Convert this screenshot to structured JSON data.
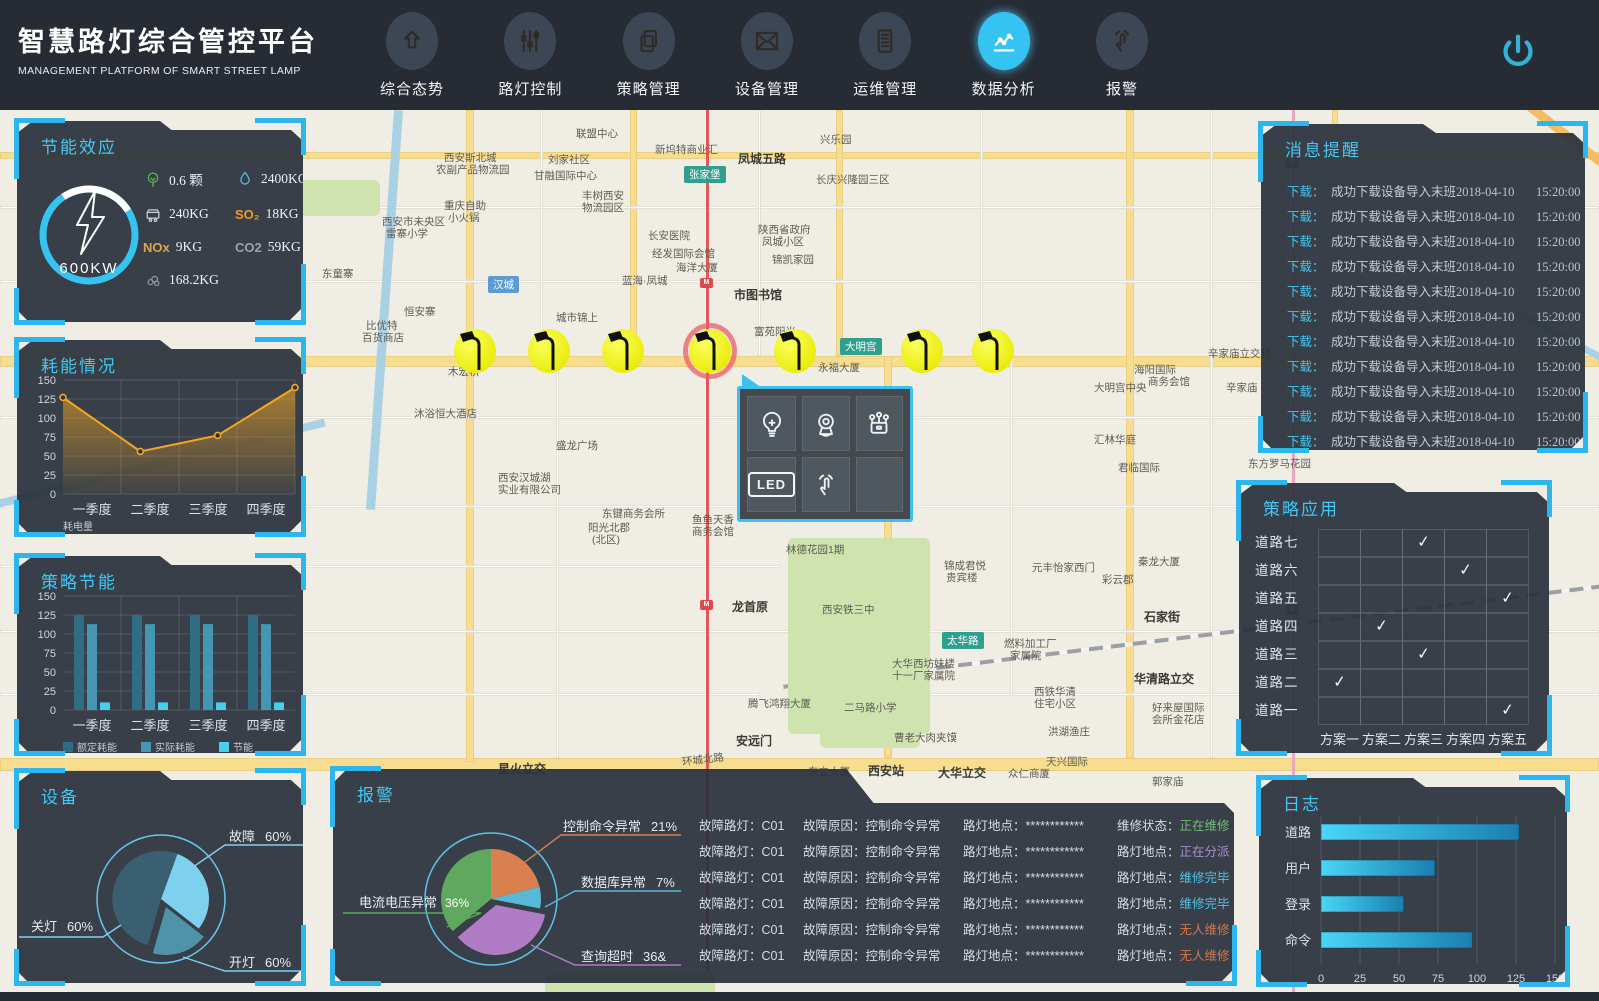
{
  "header": {
    "title": "智慧路灯综合管控平台",
    "subtitle": "MANAGEMENT PLATFORM OF SMART STREET LAMP",
    "nav": [
      {
        "label": "综合态势",
        "icon": "arrow-up-icon",
        "active": false
      },
      {
        "label": "路灯控制",
        "icon": "sliders-icon",
        "active": false
      },
      {
        "label": "策略管理",
        "icon": "copy-icon",
        "active": false
      },
      {
        "label": "设备管理",
        "icon": "mail-icon",
        "active": false
      },
      {
        "label": "运维管理",
        "icon": "document-icon",
        "active": false
      },
      {
        "label": "数据分析",
        "icon": "chart-line-icon",
        "active": true
      },
      {
        "label": "报警",
        "icon": "touch-icon",
        "active": false
      }
    ],
    "power_icon": "power-icon"
  },
  "colors": {
    "accent_cyan": "#2db6ee",
    "title_cyan": "#41c8f5",
    "panel_bg": "#2a313c",
    "header_bg": "#262b34"
  },
  "panels": {
    "energy_effect": {
      "title": "节能效应",
      "gauge": {
        "value": "600KW",
        "icon": "lightning-icon"
      },
      "stats": [
        {
          "icon": "tree-icon",
          "color": "#55b54e",
          "value": "0.6 颗"
        },
        {
          "icon": "water-drop-icon",
          "color": "#58bbe8",
          "value": "2400KG"
        },
        {
          "icon": "coal-cart-icon",
          "color": "#c7d0d6",
          "value": "240KG"
        },
        {
          "text": "SO₂",
          "color": "#f09a2e",
          "value": "18KG"
        },
        {
          "text": "NOx",
          "color": "#d8a84e",
          "value": "9KG"
        },
        {
          "text": "CO2",
          "color": "#9aa4ad",
          "value": "59KG"
        },
        {
          "icon": "smoke-icon",
          "color": "#8d97a1",
          "value": "168.2KG"
        }
      ]
    },
    "consumption": {
      "title": "耗能情况",
      "chart": {
        "type": "line",
        "categories": [
          "一季度",
          "二季度",
          "三季度",
          "四季度"
        ],
        "values": [
          127,
          56,
          77,
          140
        ],
        "yticks": [
          0,
          25,
          50,
          75,
          100,
          125,
          150
        ],
        "ylim": [
          0,
          150
        ],
        "legend": "耗电量",
        "line_color": "#f5a623"
      }
    },
    "strategy_saving": {
      "title": "策略节能",
      "chart": {
        "type": "bar",
        "categories": [
          "一季度",
          "二季度",
          "三季度",
          "四季度"
        ],
        "yticks": [
          0,
          25,
          50,
          75,
          100,
          125,
          150
        ],
        "ylim": [
          0,
          150
        ],
        "series": [
          {
            "name": "额定耗能",
            "color": "#2e6d84",
            "values": [
              125,
              125,
              125,
              125
            ]
          },
          {
            "name": "实际耗能",
            "color": "#4496b2",
            "values": [
              113,
              113,
              113,
              113
            ]
          },
          {
            "name": "节能",
            "color": "#49cdec",
            "values": [
              10,
              10,
              10,
              10
            ]
          }
        ]
      }
    },
    "device": {
      "title": "设备",
      "chart": {
        "type": "pie",
        "slices": [
          {
            "label": "故障",
            "value_text": "60%",
            "color": "#7ed0ef"
          },
          {
            "label": "开灯",
            "value_text": "60%",
            "color": "#4f93a8"
          },
          {
            "label": "关灯",
            "value_text": "60%",
            "color": "#3a5f70"
          }
        ]
      }
    },
    "messages": {
      "title": "消息提醒",
      "items": [
        {
          "prefix": "下载：",
          "text": "成功下载设备导入末班",
          "date": "2018-04-10",
          "time": "15:20:00"
        },
        {
          "prefix": "下载：",
          "text": "成功下载设备导入末班",
          "date": "2018-04-10",
          "time": "15:20:00"
        },
        {
          "prefix": "下载：",
          "text": "成功下载设备导入末班",
          "date": "2018-04-10",
          "time": "15:20:00"
        },
        {
          "prefix": "下载：",
          "text": "成功下载设备导入末班",
          "date": "2018-04-10",
          "time": "15:20:00"
        },
        {
          "prefix": "下载：",
          "text": "成功下载设备导入末班",
          "date": "2018-04-10",
          "time": "15:20:00"
        },
        {
          "prefix": "下载：",
          "text": "成功下载设备导入末班",
          "date": "2018-04-10",
          "time": "15:20:00"
        },
        {
          "prefix": "下载：",
          "text": "成功下载设备导入末班",
          "date": "2018-04-10",
          "time": "15:20:00"
        },
        {
          "prefix": "下载：",
          "text": "成功下载设备导入末班",
          "date": "2018-04-10",
          "time": "15:20:00"
        },
        {
          "prefix": "下载：",
          "text": "成功下载设备导入末班",
          "date": "2018-04-10",
          "time": "15:20:00"
        },
        {
          "prefix": "下载：",
          "text": "成功下载设备导入末班",
          "date": "2018-04-10",
          "time": "15:20:00"
        },
        {
          "prefix": "下载：",
          "text": "成功下载设备导入末班",
          "date": "2018-04-10",
          "time": "15:20:00"
        }
      ]
    },
    "strategy_apply": {
      "title": "策略应用",
      "roads": [
        "道路七",
        "道路六",
        "道路五",
        "道路四",
        "道路三",
        "道路二",
        "道路一"
      ],
      "plans": [
        "方案一",
        "方案二",
        "方案三",
        "方案四",
        "方案五"
      ],
      "checks": [
        3,
        4,
        5,
        2,
        3,
        1,
        5
      ],
      "check_glyph": "✓"
    },
    "log": {
      "title": "日志",
      "chart": {
        "type": "bar-horizontal",
        "categories": [
          "道路",
          "用户",
          "登录",
          "命令"
        ],
        "values": [
          127,
          73,
          53,
          97
        ],
        "xticks": [
          0,
          25,
          50,
          75,
          100,
          125,
          150
        ],
        "xlim": [
          0,
          150
        ],
        "bar_color_start": "#48d6f8",
        "bar_color_end": "#1a7fb0"
      }
    },
    "alarm": {
      "title": "报警",
      "pie": {
        "slices": [
          {
            "label": "电流电压异常",
            "pct": "36%",
            "color": "#5fa85d"
          },
          {
            "label": "控制命令异常",
            "pct": "21%",
            "color": "#d9804f"
          },
          {
            "label": "数据库异常",
            "pct": "7%",
            "color": "#58b8d8"
          },
          {
            "label": "查询超时",
            "pct": "36&",
            "color": "#b07cc6"
          }
        ],
        "inner_value": "36%"
      },
      "rows": [
        {
          "c1l": "故障路灯：",
          "c1": "C01",
          "c2l": "故障原因：",
          "c2": "控制命令异常",
          "c3l": "路灯地点：",
          "c3": "************",
          "c4l": "维修状态：",
          "c4": "正在维修",
          "c4c": "#6fbf73"
        },
        {
          "c1l": "故障路灯：",
          "c1": "C01",
          "c2l": "故障原因：",
          "c2": "控制命令异常",
          "c3l": "路灯地点：",
          "c3": "************",
          "c4l": "路灯地点：",
          "c4": "正在分派",
          "c4c": "#a98fd1"
        },
        {
          "c1l": "故障路灯：",
          "c1": "C01",
          "c2l": "故障原因：",
          "c2": "控制命令异常",
          "c3l": "路灯地点：",
          "c3": "************",
          "c4l": "路灯地点：",
          "c4": "维修完毕",
          "c4c": "#4fc3e8"
        },
        {
          "c1l": "故障路灯：",
          "c1": "C01",
          "c2l": "故障原因：",
          "c2": "控制命令异常",
          "c3l": "路灯地点：",
          "c3": "************",
          "c4l": "路灯地点：",
          "c4": "维修完毕",
          "c4c": "#4fc3e8"
        },
        {
          "c1l": "故障路灯：",
          "c1": "C01",
          "c2l": "故障原因：",
          "c2": "控制命令异常",
          "c3l": "路灯地点：",
          "c3": "************",
          "c4l": "路灯地点：",
          "c4": "无人维修",
          "c4c": "#d4764f"
        },
        {
          "c1l": "故障路灯：",
          "c1": "C01",
          "c2l": "故障原因：",
          "c2": "控制命令异常",
          "c3l": "路灯地点：",
          "c3": "************",
          "c4l": "路灯地点：",
          "c4": "无人维修",
          "c4c": "#d4764f"
        }
      ]
    }
  },
  "map": {
    "badges": [
      {
        "text": "汉城",
        "x": 488,
        "y": 166,
        "color": "#5b9bd5"
      },
      {
        "text": "张家堡",
        "x": 684,
        "y": 56,
        "color": "#2fa08e"
      },
      {
        "text": "大明宫",
        "x": 840,
        "y": 228,
        "color": "#2fa08e"
      },
      {
        "text": "太华路",
        "x": 942,
        "y": 522,
        "color": "#2fa08e"
      }
    ],
    "labels": [
      {
        "text": "联盟中心",
        "x": 576,
        "y": 16
      },
      {
        "text": "新坞特商业汇",
        "x": 655,
        "y": 32
      },
      {
        "text": "凤城五路",
        "x": 738,
        "y": 40,
        "bold": 1
      },
      {
        "text": "兴乐园",
        "x": 820,
        "y": 22
      },
      {
        "text": "长庆兴隆园三区",
        "x": 816,
        "y": 62
      },
      {
        "text": "刘家社区",
        "x": 548,
        "y": 42
      },
      {
        "text": "西安斯北城",
        "x": 444,
        "y": 40
      },
      {
        "text": "农副产品物流园",
        "x": 436,
        "y": 52
      },
      {
        "text": "甘融国际中心",
        "x": 534,
        "y": 58
      },
      {
        "text": "丰树西安",
        "x": 582,
        "y": 78
      },
      {
        "text": "物流园区",
        "x": 582,
        "y": 90
      },
      {
        "text": "重庆自助",
        "x": 444,
        "y": 88
      },
      {
        "text": "小火锅",
        "x": 448,
        "y": 100
      },
      {
        "text": "西安市未央区",
        "x": 382,
        "y": 104
      },
      {
        "text": "雷寨小学",
        "x": 386,
        "y": 116
      },
      {
        "text": "东童寨",
        "x": 322,
        "y": 156
      },
      {
        "text": "长安医院",
        "x": 648,
        "y": 118
      },
      {
        "text": "经发国际会馆",
        "x": 652,
        "y": 136
      },
      {
        "text": "陕西省政府",
        "x": 758,
        "y": 112
      },
      {
        "text": "凤城小区",
        "x": 762,
        "y": 124
      },
      {
        "text": "锦凯家园",
        "x": 772,
        "y": 142
      },
      {
        "text": "海洋大厦",
        "x": 676,
        "y": 150
      },
      {
        "text": "蓝海·凤城",
        "x": 622,
        "y": 163
      },
      {
        "text": "市图书馆",
        "x": 734,
        "y": 176,
        "bold": 1
      },
      {
        "text": "城市锦上",
        "x": 556,
        "y": 200
      },
      {
        "text": "恒安寨",
        "x": 404,
        "y": 194
      },
      {
        "text": "比优特",
        "x": 366,
        "y": 208
      },
      {
        "text": "百货商店",
        "x": 362,
        "y": 220
      },
      {
        "text": "富苑阳光",
        "x": 754,
        "y": 214
      },
      {
        "text": "木宏桥",
        "x": 448,
        "y": 254
      },
      {
        "text": "永福大厦",
        "x": 818,
        "y": 250
      },
      {
        "text": "海阳国际",
        "x": 1134,
        "y": 252
      },
      {
        "text": "商务会馆",
        "x": 1148,
        "y": 264
      },
      {
        "text": "大明宫中央",
        "x": 1094,
        "y": 270
      },
      {
        "text": "辛家庙立交桥",
        "x": 1208,
        "y": 236
      },
      {
        "text": "辛家庙",
        "x": 1226,
        "y": 270
      },
      {
        "text": "汇林华庭",
        "x": 1094,
        "y": 322
      },
      {
        "text": "君临国际",
        "x": 1118,
        "y": 350
      },
      {
        "text": "东方罗马花园",
        "x": 1248,
        "y": 346
      },
      {
        "text": "盛龙广场",
        "x": 556,
        "y": 328
      },
      {
        "text": "沐浴恒大酒店",
        "x": 414,
        "y": 296
      },
      {
        "text": "西安汉城湖",
        "x": 498,
        "y": 360
      },
      {
        "text": "实业有限公司",
        "x": 498,
        "y": 372
      },
      {
        "text": "东键商务会所",
        "x": 602,
        "y": 396
      },
      {
        "text": "阳光北郡",
        "x": 588,
        "y": 410
      },
      {
        "text": "(北区)",
        "x": 592,
        "y": 422
      },
      {
        "text": "鱼鱼天香",
        "x": 692,
        "y": 402
      },
      {
        "text": "商务会馆",
        "x": 692,
        "y": 414
      },
      {
        "text": "林德花园1期",
        "x": 786,
        "y": 432
      },
      {
        "text": "龙首原",
        "x": 732,
        "y": 488,
        "bold": 1
      },
      {
        "text": "西安铁三中",
        "x": 822,
        "y": 492
      },
      {
        "text": "锦成君悦",
        "x": 944,
        "y": 448
      },
      {
        "text": "贵宾楼",
        "x": 946,
        "y": 460
      },
      {
        "text": "元丰怡家西门",
        "x": 1032,
        "y": 450
      },
      {
        "text": "彩云郡",
        "x": 1102,
        "y": 462
      },
      {
        "text": "秦龙大厦",
        "x": 1138,
        "y": 444
      },
      {
        "text": "石家街",
        "x": 1144,
        "y": 498,
        "bold": 1
      },
      {
        "text": "燃料加工厂",
        "x": 1004,
        "y": 526
      },
      {
        "text": "家属院",
        "x": 1010,
        "y": 538
      },
      {
        "text": "大华西坊妹楼",
        "x": 892,
        "y": 546
      },
      {
        "text": "十一厂家属院",
        "x": 892,
        "y": 558
      },
      {
        "text": "西铁华清",
        "x": 1034,
        "y": 574
      },
      {
        "text": "住宅小区",
        "x": 1034,
        "y": 586
      },
      {
        "text": "华清路立交",
        "x": 1134,
        "y": 560,
        "bold": 1
      },
      {
        "text": "好来屋国际",
        "x": 1152,
        "y": 590
      },
      {
        "text": "会所金花店",
        "x": 1152,
        "y": 602
      },
      {
        "text": "洪湖渔庄",
        "x": 1048,
        "y": 614
      },
      {
        "text": "二马路小学",
        "x": 844,
        "y": 590
      },
      {
        "text": "腾飞鸿翔大厦",
        "x": 748,
        "y": 586
      },
      {
        "text": "安远门",
        "x": 736,
        "y": 622,
        "bold": 1
      },
      {
        "text": "曹老大肉夹馍",
        "x": 894,
        "y": 620
      },
      {
        "text": "西安站",
        "x": 868,
        "y": 652,
        "bold": 1
      },
      {
        "text": "东立大厦",
        "x": 808,
        "y": 654
      },
      {
        "text": "大华立交",
        "x": 938,
        "y": 654,
        "bold": 1
      },
      {
        "text": "众仁商厦",
        "x": 1008,
        "y": 656
      },
      {
        "text": "天兴国际",
        "x": 1046,
        "y": 644
      },
      {
        "text": "郭家庙",
        "x": 1152,
        "y": 664
      },
      {
        "text": "星火立交",
        "x": 498,
        "y": 650,
        "bold": 1
      },
      {
        "text": "环城北路",
        "x": 682,
        "y": 642,
        "rot": -7
      }
    ],
    "lamps": {
      "positions_x": [
        475,
        549,
        623,
        710,
        795,
        922,
        993
      ],
      "y": 218,
      "highlighted_index": 3
    },
    "popup": {
      "icons": [
        "bulb-icon",
        "camera-icon",
        "sensor-icon",
        "led-icon",
        "touch-icon",
        ""
      ],
      "led_label": "LED"
    }
  }
}
